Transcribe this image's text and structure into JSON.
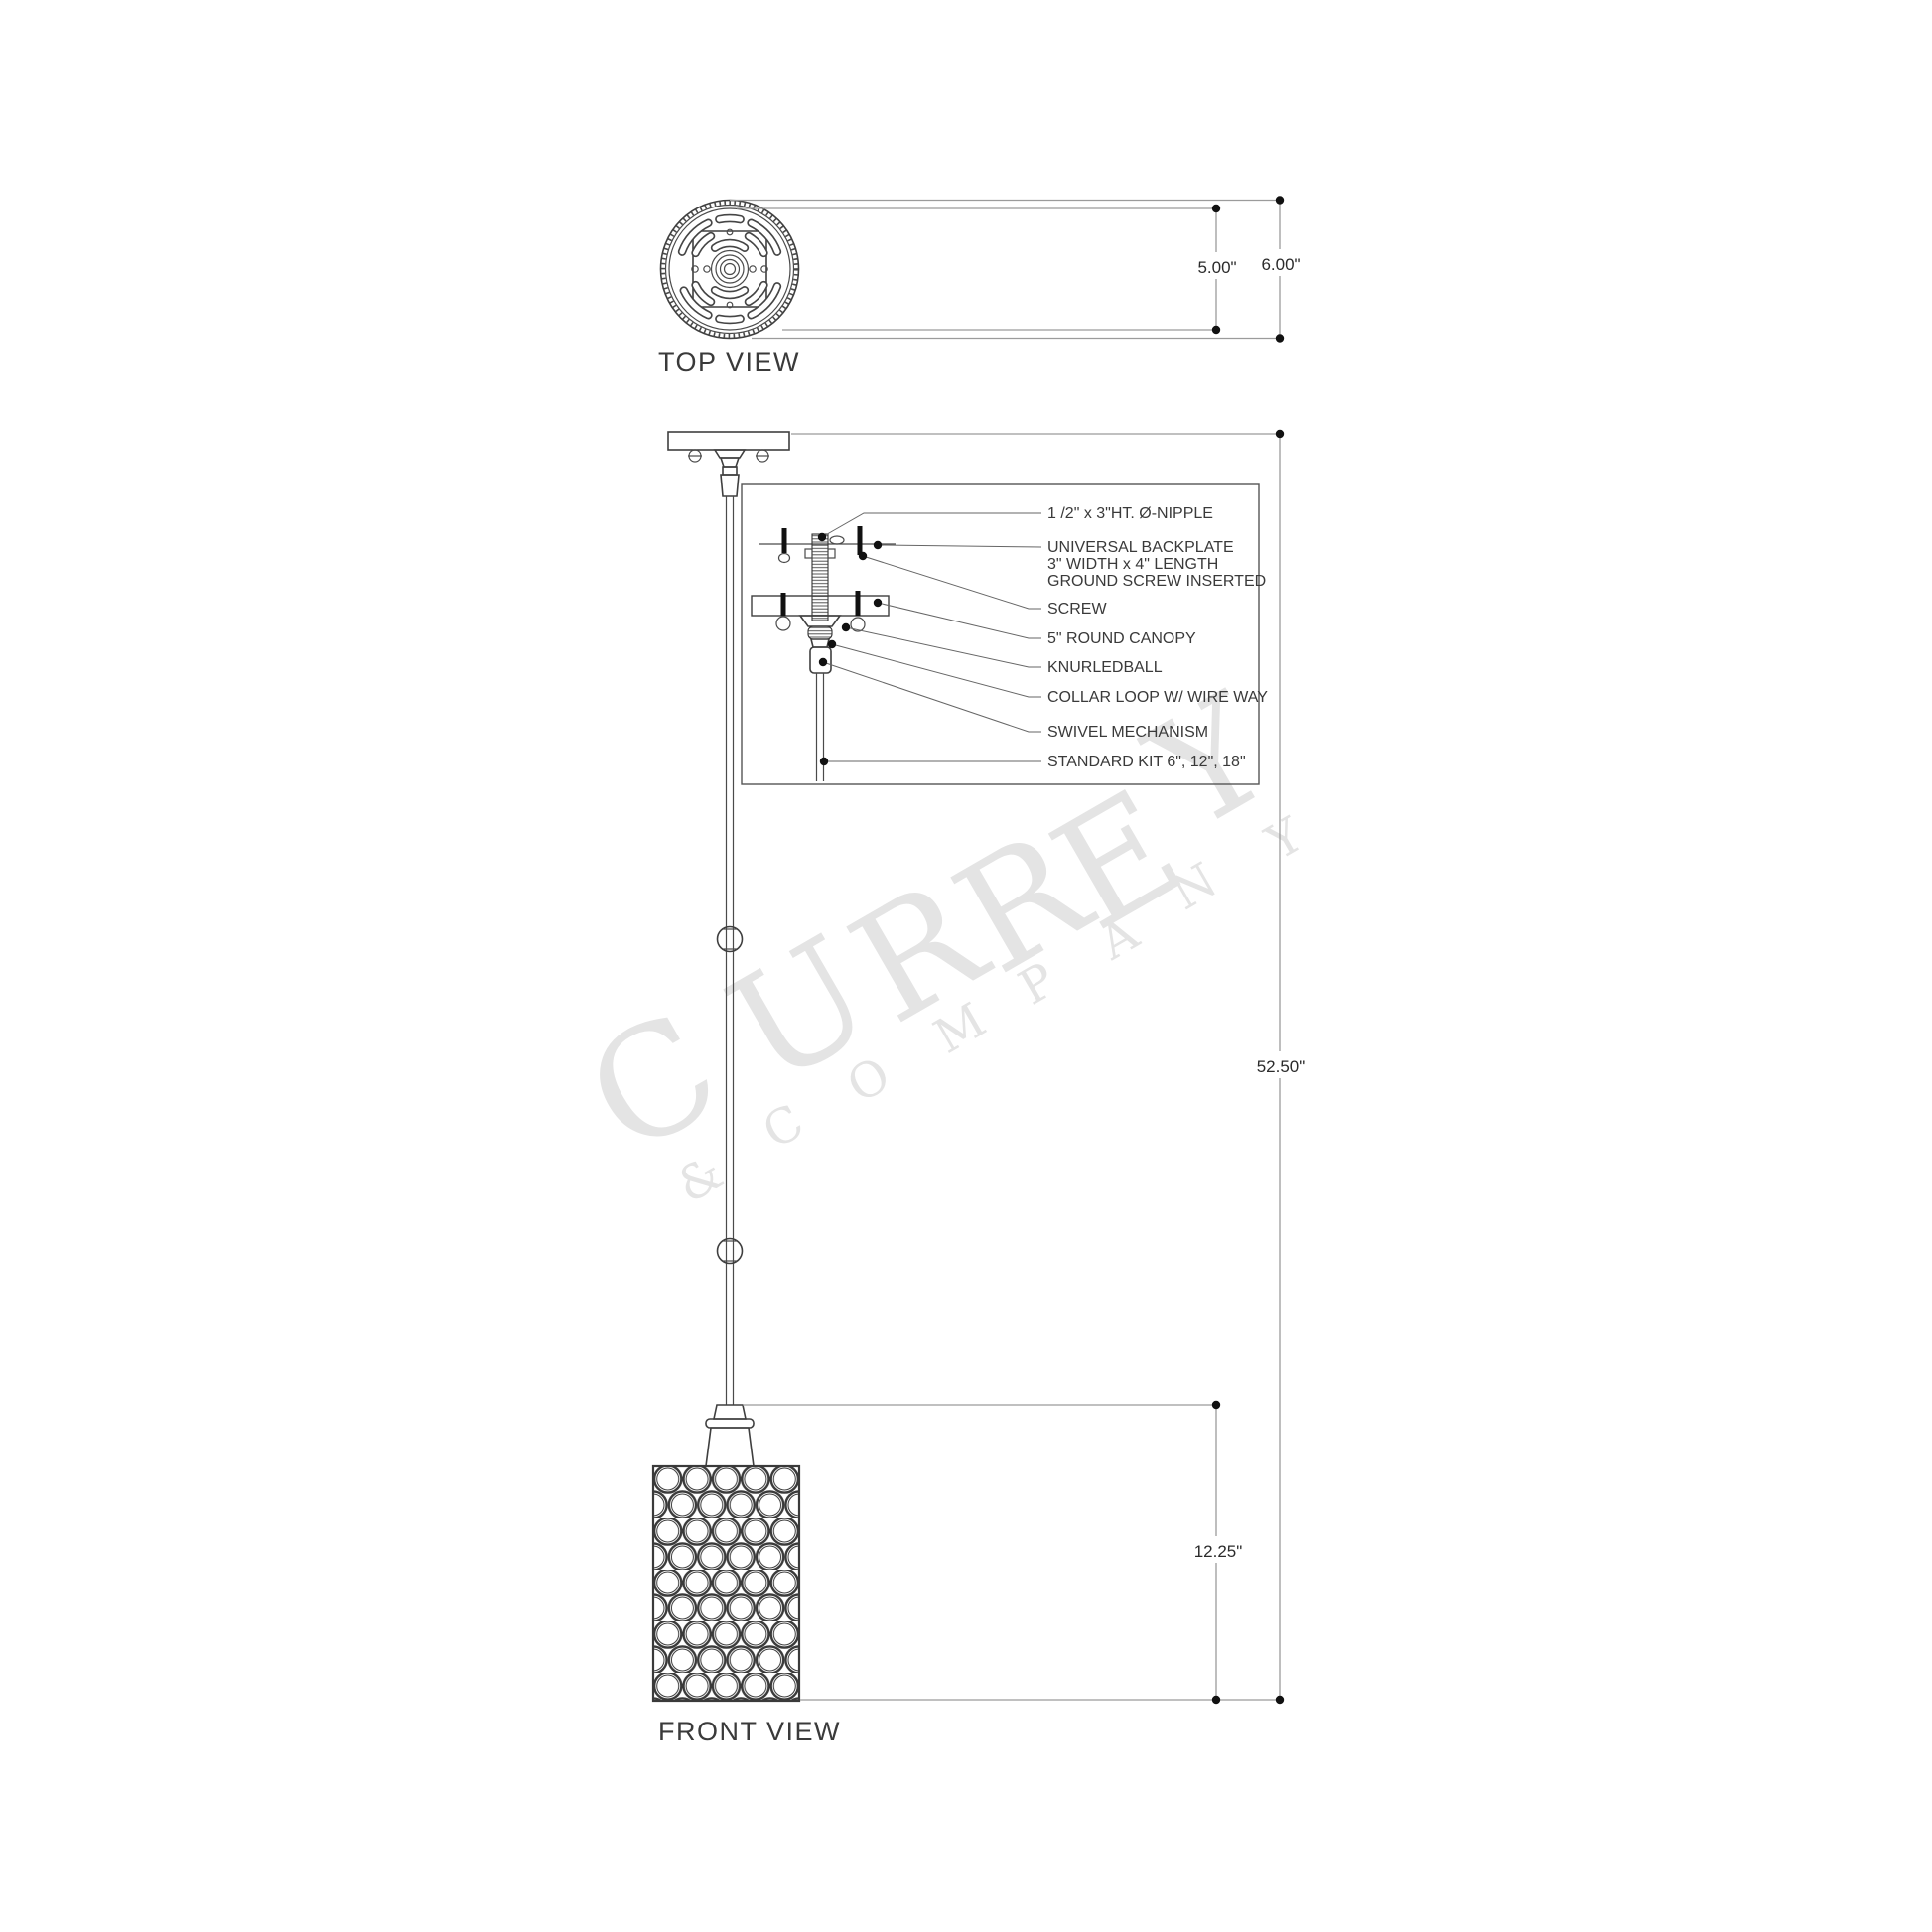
{
  "views": {
    "top_label": "TOP VIEW",
    "front_label": "FRONT VIEW"
  },
  "dimensions": {
    "canopy_inner": "5.00\"",
    "canopy_outer": "6.00\"",
    "overall_height": "52.50\"",
    "shade_height": "12.25\""
  },
  "callouts": [
    {
      "label": "1 /2\" x 3\"HT. Ø-NIPPLE"
    },
    {
      "line1": "UNIVERSAL BACKPLATE",
      "line2": "3\" WIDTH x 4\" LENGTH",
      "line3": "GROUND SCREW INSERTED"
    },
    {
      "label": "SCREW"
    },
    {
      "label": "5\" ROUND CANOPY"
    },
    {
      "label": "KNURLEDBALL"
    },
    {
      "label": "COLLAR LOOP W/ WIRE WAY"
    },
    {
      "label": "SWIVEL MECHANISM"
    },
    {
      "label": "STANDARD KIT 6\", 12\", 18\""
    }
  ],
  "watermark": {
    "brand": "CURREY",
    "company": "&COMPANY"
  },
  "colors": {
    "line": "#3f3f3f",
    "dimension_line": "#9b9b9b",
    "watermark": "#e4e4e4"
  }
}
